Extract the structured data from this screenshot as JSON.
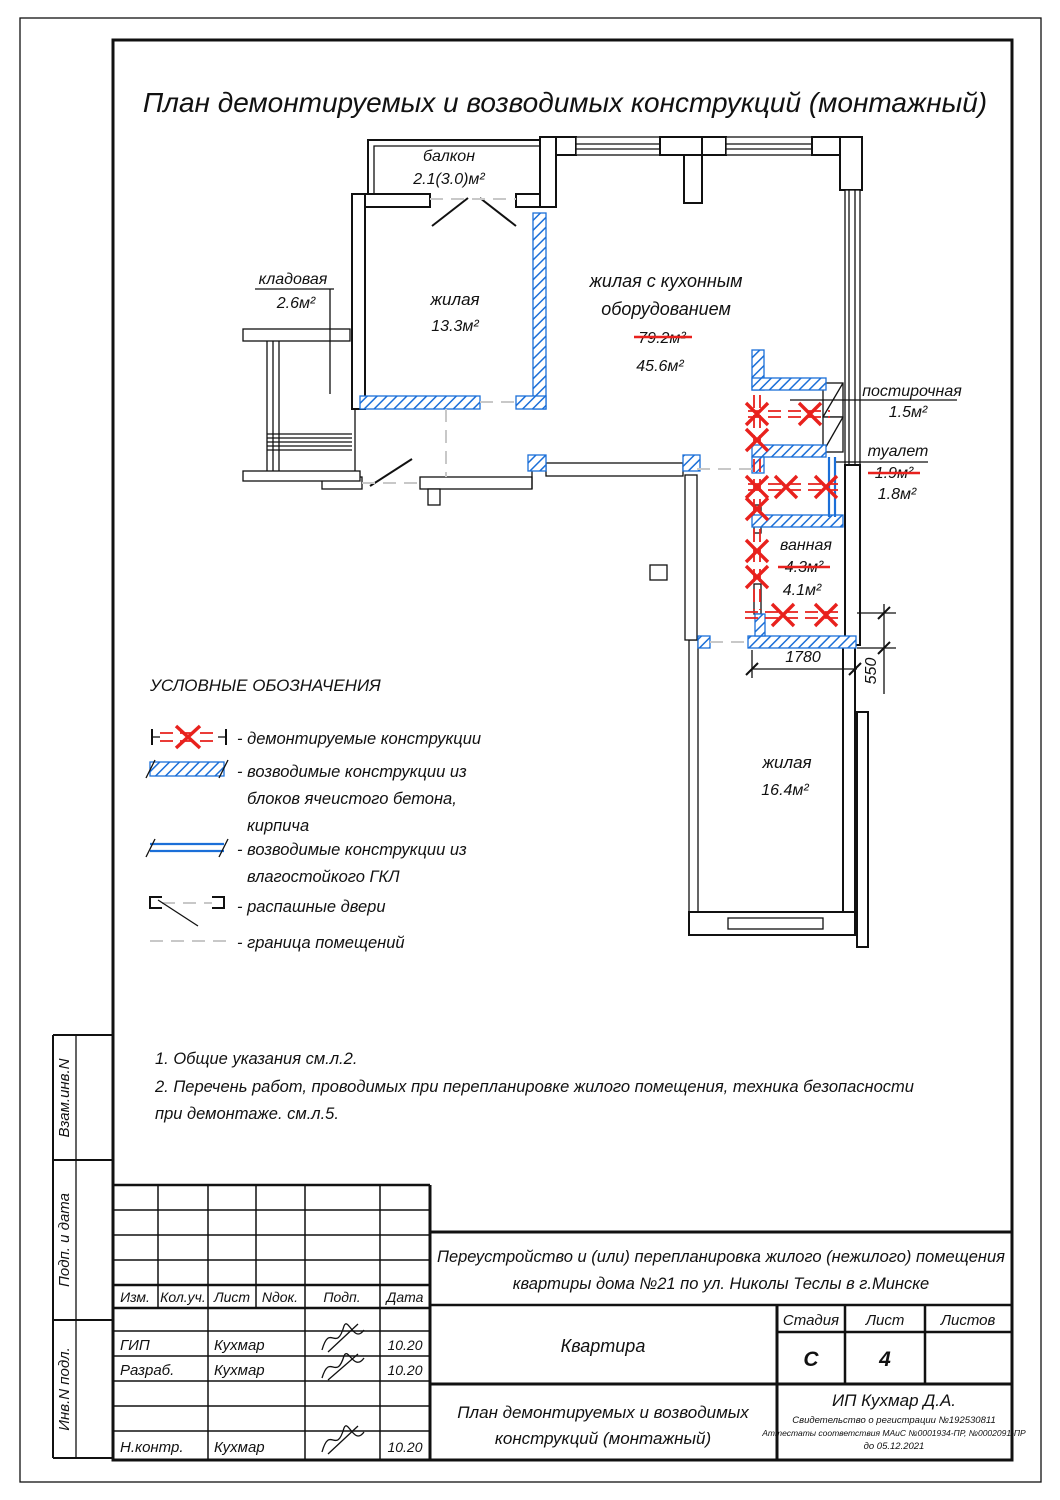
{
  "title": "План демонтируемых и возводимых конструкций (монтажный)",
  "plan": {
    "balcony": {
      "name": "балкон",
      "area": "2.1(3.0)м²"
    },
    "room_living1": {
      "name": "жилая",
      "area": "13.3м²"
    },
    "room_kitchen": {
      "name1": "жилая с кухонным",
      "name2": "оборудованием",
      "area_old": "79.2м²",
      "area_new": "45.6м²"
    },
    "storage": {
      "name": "кладовая",
      "area": "2.6м²"
    },
    "laundry": {
      "name": "постирочная",
      "area": "1.5м²"
    },
    "toilet": {
      "name": "туалет",
      "area_old": "1.9м²",
      "area_new": "1.8м²"
    },
    "bathroom": {
      "name": "ванная",
      "area_old": "4.3м²",
      "area_new": "4.1м²"
    },
    "room_living2": {
      "name": "жилая",
      "area": "16.4м²"
    },
    "dim_width": "1780",
    "dim_offset": "550"
  },
  "legend": {
    "title": "УСЛОВНЫЕ ОБОЗНАЧЕНИЯ",
    "item_demolish": "- демонтируемые конструкции",
    "item_blocks1": "- возводимые конструкции из",
    "item_blocks2": "блоков ячеистого бетона,",
    "item_blocks3": "кирпича",
    "item_gkl1": "- возводимые конструкции из",
    "item_gkl2": "влагостойкого ГКЛ",
    "item_doors": "- распашные двери",
    "item_boundary": "- граница помещений"
  },
  "notes": {
    "line1": "1. Общие указания см.л.2.",
    "line2": "2. Перечень работ, проводимых при перепланировке жилого помещения, техника безопасности",
    "line3": "при демонтаже. см.л.5."
  },
  "sidebar": {
    "box1": "Взам.инв.N",
    "box2": "Подп. и дата",
    "box3": "Инв.N подл."
  },
  "titleblock": {
    "cols": {
      "izm": "Изм.",
      "koluch": "Кол.уч.",
      "list": "Лист",
      "ndok": "Nдок.",
      "podp": "Подп.",
      "data": "Дата"
    },
    "row_gip": {
      "role": "ГИП",
      "name": "Кухмар",
      "date": "10.20"
    },
    "row_razrab": {
      "role": "Разраб.",
      "name": "Кухмар",
      "date": "10.20"
    },
    "row_nkontr": {
      "role": "Н.контр.",
      "name": "Кухмар",
      "date": "10.20"
    },
    "project1": "Переустройство и (или) перепланировка жилого (нежилого) помещения",
    "project2": "квартиры  дома №21 по ул. Николы Теслы в г.Минске",
    "object": "Квартира",
    "stage_label": "Стадия",
    "sheet_label": "Лист",
    "sheets_label": "Листов",
    "stage": "С",
    "sheet": "4",
    "doc1": "План демонтируемых и возводимых",
    "doc2": "конструкций (монтажный)",
    "company": "ИП Кухмар Д.А.",
    "cert1": "Свидетельство о регистрации №192530811",
    "cert2": "Аттестаты соответствия МАиС №0001934-ПР, №0002091-ПР",
    "cert3": "до 05.12.2021"
  },
  "colors": {
    "new_construction": "#1b6fd8",
    "demolition": "#e8211d",
    "line": "#111111",
    "boundary": "#c8c8c8"
  }
}
